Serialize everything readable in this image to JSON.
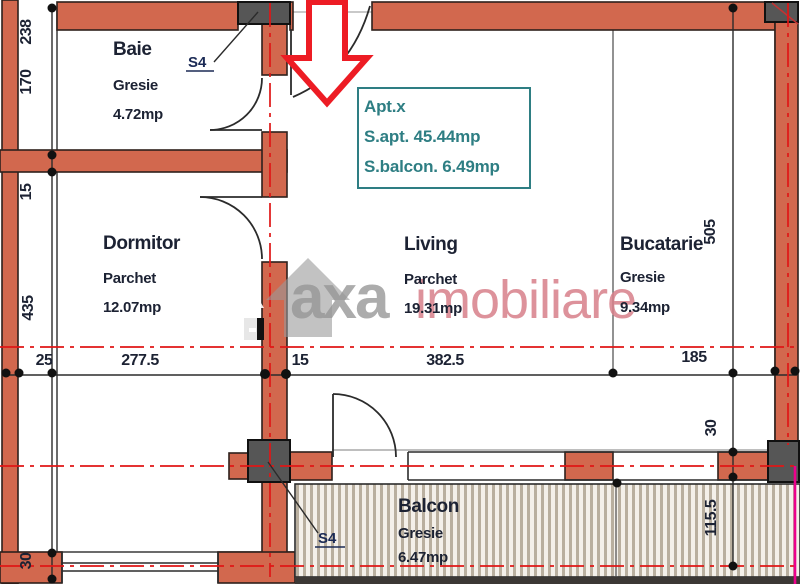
{
  "plan": {
    "entrance_marker": "entrance-arrow-down",
    "watermark": {
      "brand_left": "axa",
      "brand_right": "imobiliare"
    },
    "info_box": {
      "line1": "Apt.x",
      "line2": "S.apt.  45.44mp",
      "line3": "S.balcon.  6.49mp"
    },
    "rooms": {
      "baie": {
        "name": "Baie",
        "floor": "Gresie",
        "area": "4.72mp"
      },
      "dormitor": {
        "name": "Dormitor",
        "floor": "Parchet",
        "area": "12.07mp"
      },
      "living": {
        "name": "Living",
        "floor": "Parchet",
        "area": "19.31mp"
      },
      "bucatarie": {
        "name": "Bucatarie",
        "floor": "Gresie",
        "area": "9.34mp"
      },
      "balcon": {
        "name": "Balcon",
        "floor": "Gresie",
        "area": "6.47mp"
      }
    },
    "column_labels": {
      "s4_top": "S4",
      "s4_bottom": "S4"
    },
    "dimensions": {
      "left": [
        {
          "text": "238"
        },
        {
          "text": "170"
        },
        {
          "text": "15"
        },
        {
          "text": "435"
        },
        {
          "text": "30"
        }
      ],
      "bottom": [
        {
          "text": "25"
        },
        {
          "text": "277.5"
        },
        {
          "text": "15"
        },
        {
          "text": "382.5"
        },
        {
          "text": "185"
        }
      ],
      "right": [
        {
          "text": "505"
        },
        {
          "text": "30"
        },
        {
          "text": "115.5"
        }
      ]
    },
    "colors": {
      "wall": "#d2684e",
      "column": "#565656",
      "centerline_red": "#e01616",
      "magenta": "#ec008c",
      "arrow_red": "#ed1c24",
      "accent_teal": "#2e7e83",
      "watermark_gray": "#969696",
      "watermark_pink": "#d87f8a",
      "text_navy": "#1c2233"
    }
  }
}
